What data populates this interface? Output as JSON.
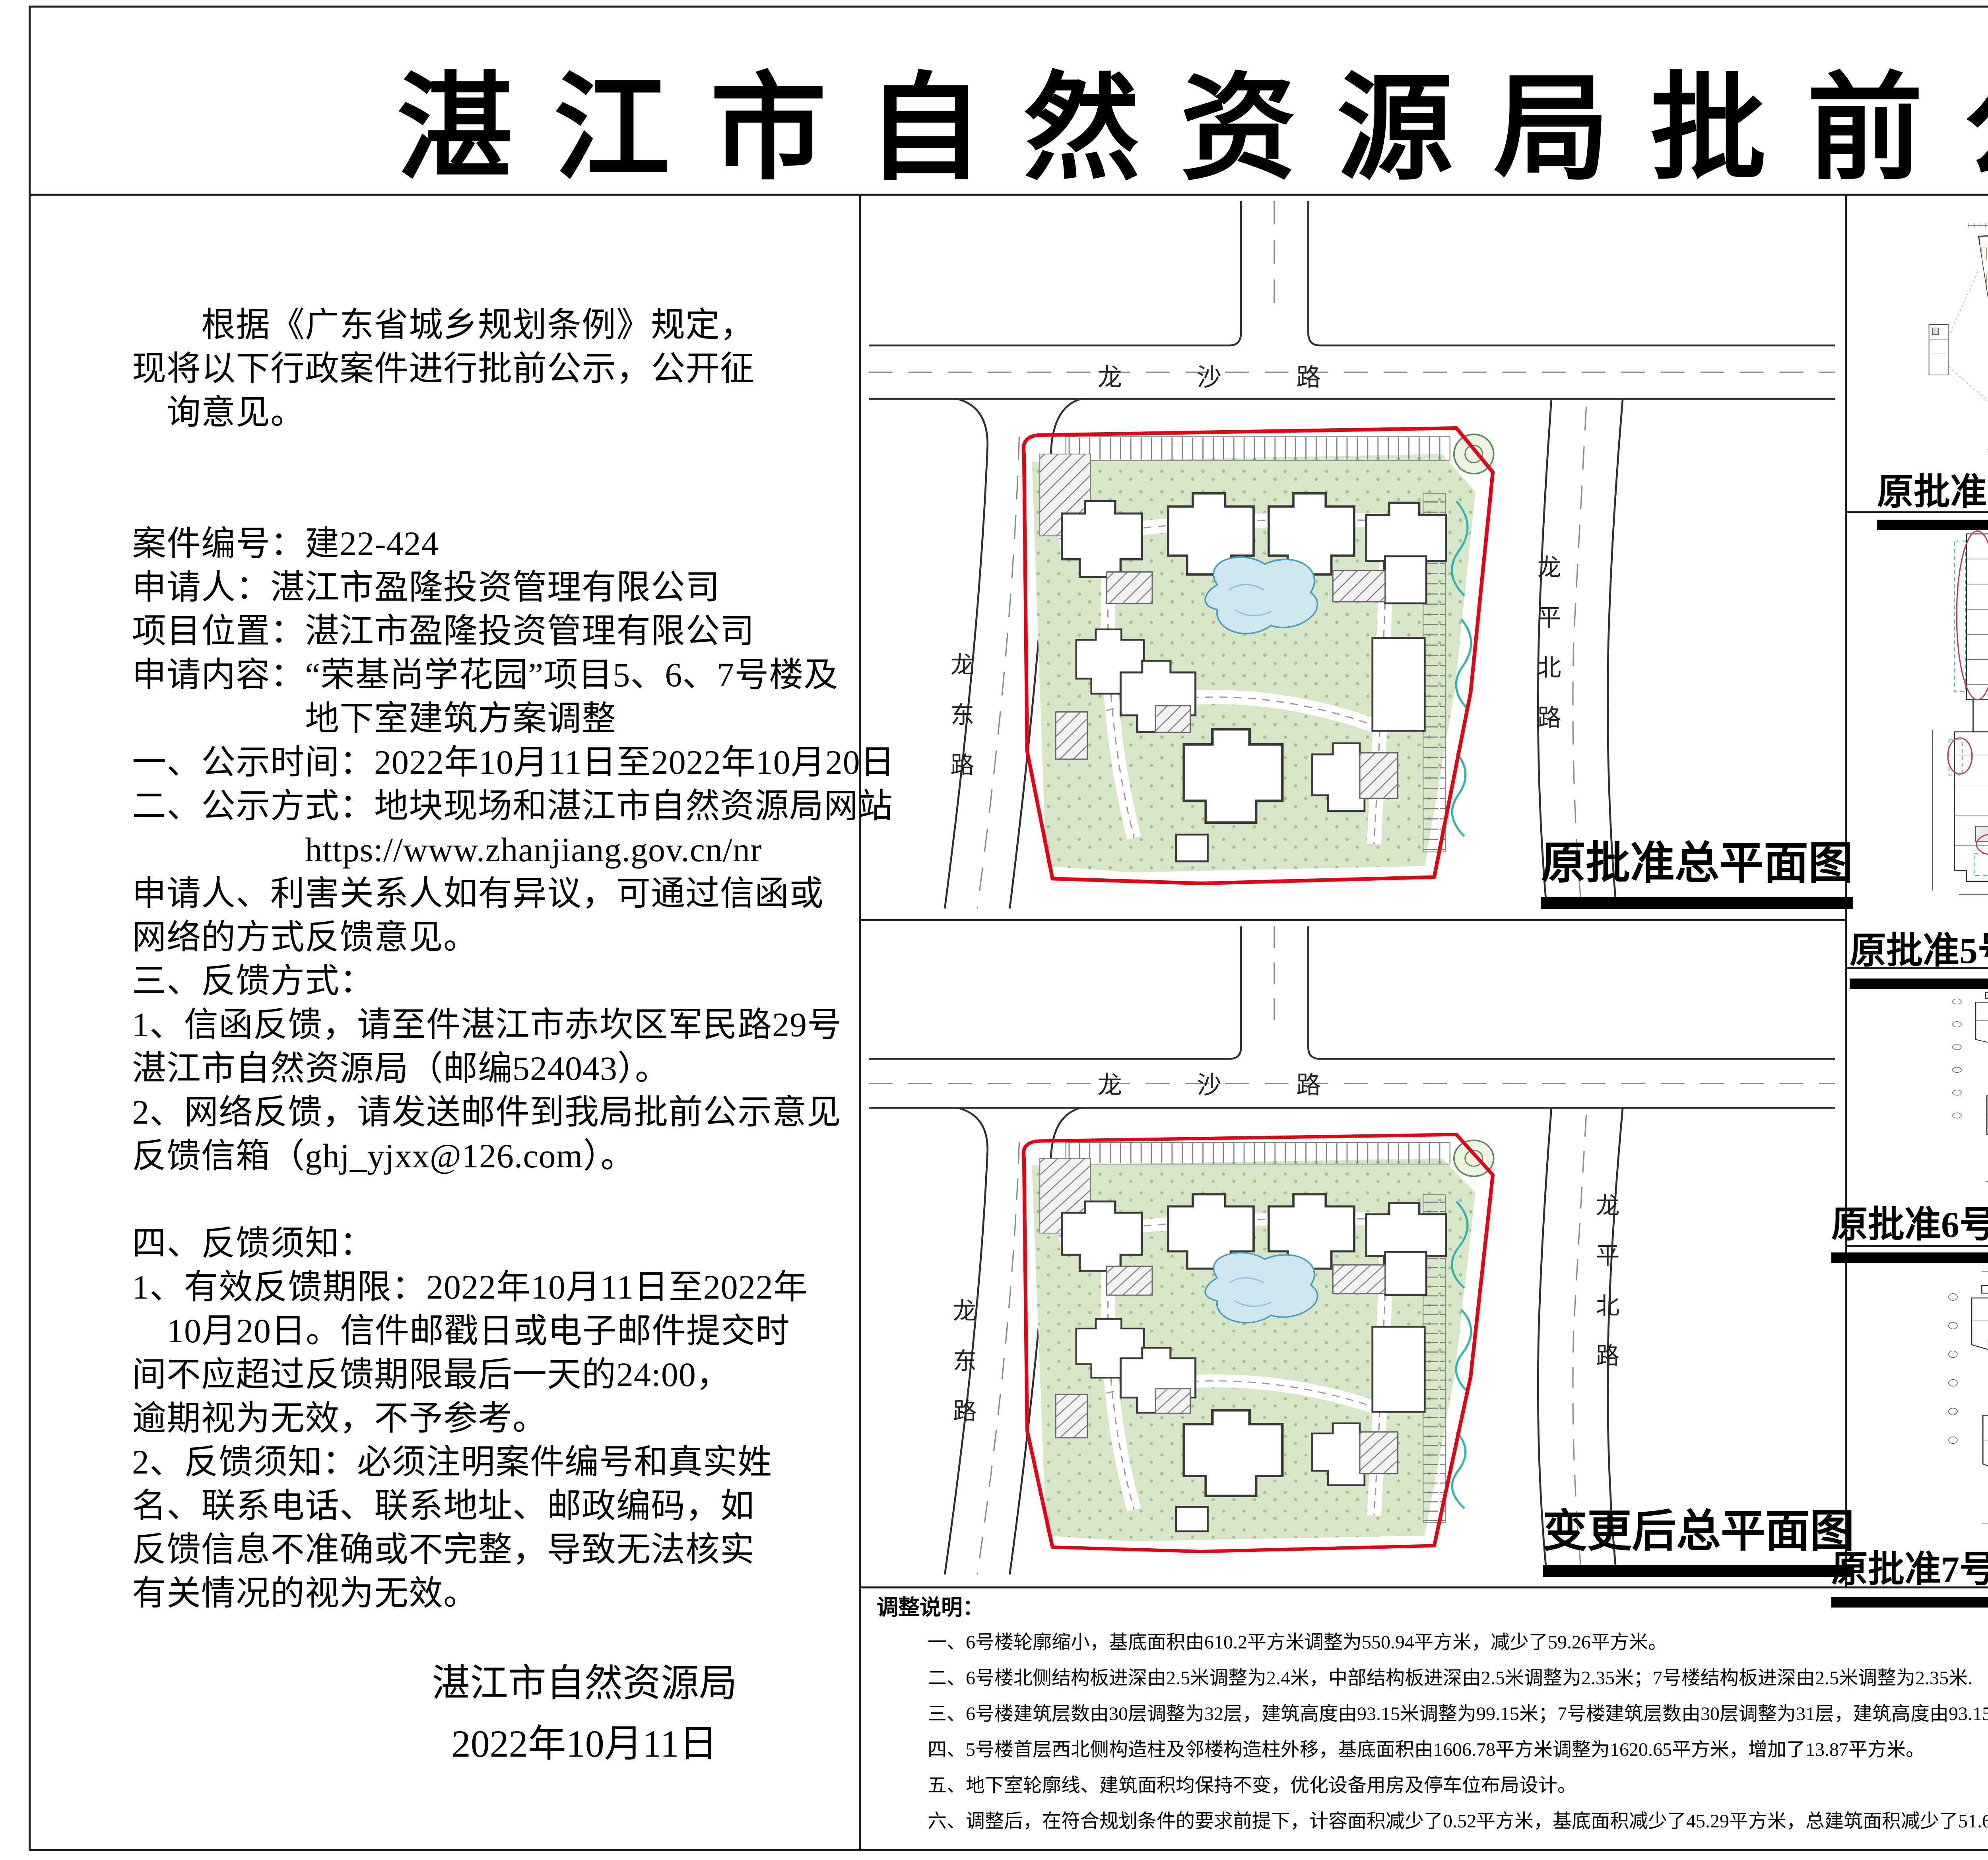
{
  "page": {
    "title": "湛江市自然资源局批前公示"
  },
  "left_panel": {
    "lines": [
      "　　根据《广东省城乡规划条例》规定，",
      "现将以下行政案件进行批前公示，公开征",
      "　询意见。",
      "",
      "",
      "案件编号：建22-424",
      "申请人：湛江市盈隆投资管理有限公司",
      "项目位置：湛江市盈隆投资管理有限公司",
      "申请内容：“荣基尚学花园”项目5、6、7号楼及",
      "　　　　　地下室建筑方案调整",
      "一、公示时间：2022年10月11日至2022年10月20日",
      "二、公示方式：地块现场和湛江市自然资源局网站",
      "　　　　　https://www.zhanjiang.gov.cn/nr",
      "申请人、利害关系人如有异议，可通过信函或",
      "网络的方式反馈意见。",
      "三、反馈方式：",
      "1、信函反馈，请至件湛江市赤坎区军民路29号",
      "湛江市自然资源局（邮编524043）。",
      "2、网络反馈，请发送邮件到我局批前公示意见",
      "反馈信箱（ghj_yjxx@126.com）。",
      "",
      "四、反馈须知：",
      "1、有效反馈期限：2022年10月11日至2022年",
      "　10月20日。信件邮戳日或电子邮件提交时",
      "间不应超过反馈期限最后一天的24:00，",
      "逾期视为无效，不予参考。",
      "2、反馈须知：必须注明案件编号和真实姓",
      "名、联系电话、联系地址、邮政编码，如",
      "反馈信息不准确或不完整，导致无法核实",
      "有关情况的视为无效。"
    ],
    "signature": {
      "agency": "湛江市自然资源局",
      "date": "2022年10月11日"
    }
  },
  "site_plans": {
    "roads": {
      "top": "龙沙路",
      "left": "龙东路",
      "right": "龙平北路"
    },
    "original": {
      "caption": "原批准总平面图"
    },
    "changed": {
      "caption": "变更后总平面图"
    }
  },
  "plan_grid": {
    "rows": [
      {
        "left": "原批准负一层平面图",
        "right": "变更后负一层平面图"
      },
      {
        "left": "原批准5号楼一层平面图",
        "right": "变更后5号楼一层平面图"
      },
      {
        "left": "原批准6号楼标准层平面图",
        "right": "变更后6号楼标准层平面图"
      },
      {
        "left": "原批准7号楼标准层平面图",
        "right": "变更后7号楼标准层平面图"
      }
    ]
  },
  "bldg5_dims": {
    "right": "2391 1891 1545 2245 1954 2012 2333 2187 1079",
    "bottom": "1895 1050 1050 1637 553 1459",
    "left": "2770 1137 1079 700 700 1487"
  },
  "notes": {
    "heading": "调整说明：",
    "items": [
      "一、6号楼轮廓缩小，基底面积由610.2平方米调整为550.94平方米，减少了59.26平方米。",
      "二、6号楼北侧结构板进深由2.5米调整为2.4米，中部结构板进深由2.5米调整为2.35米；7号楼结构板进深由2.5米调整为2.35米.",
      "三、6号楼建筑层数由30层调整为32层，建筑高度由93.15米调整为99.15米；7号楼建筑层数由30层调整为31层，建筑高度由93.15米调整为96.15米。",
      "四、5号楼首层西北侧构造柱及邻楼构造柱外移，基底面积由1606.78平方米调整为1620.65平方米，增加了13.87平方米。",
      "五、地下室轮廓线、建筑面积均保持不变，优化设备用房及停车位布局设计。",
      "六、调整后，在符合规划条件的要求前提下，计容面积减少了0.52平方米，基底面积减少了45.29平方米，总建筑面积减少了51.6平方米；非机动车停车位保持不变，机动车停车位增加了2个。"
    ]
  },
  "colors": {
    "boundary_red": "#e60012",
    "annotation_red": "#cc3344",
    "green_fill": "#d8e6c8",
    "pond_blue": "#cfe6f0",
    "teal": "#2ab5ad",
    "parking_tan": "#b09a6e"
  }
}
